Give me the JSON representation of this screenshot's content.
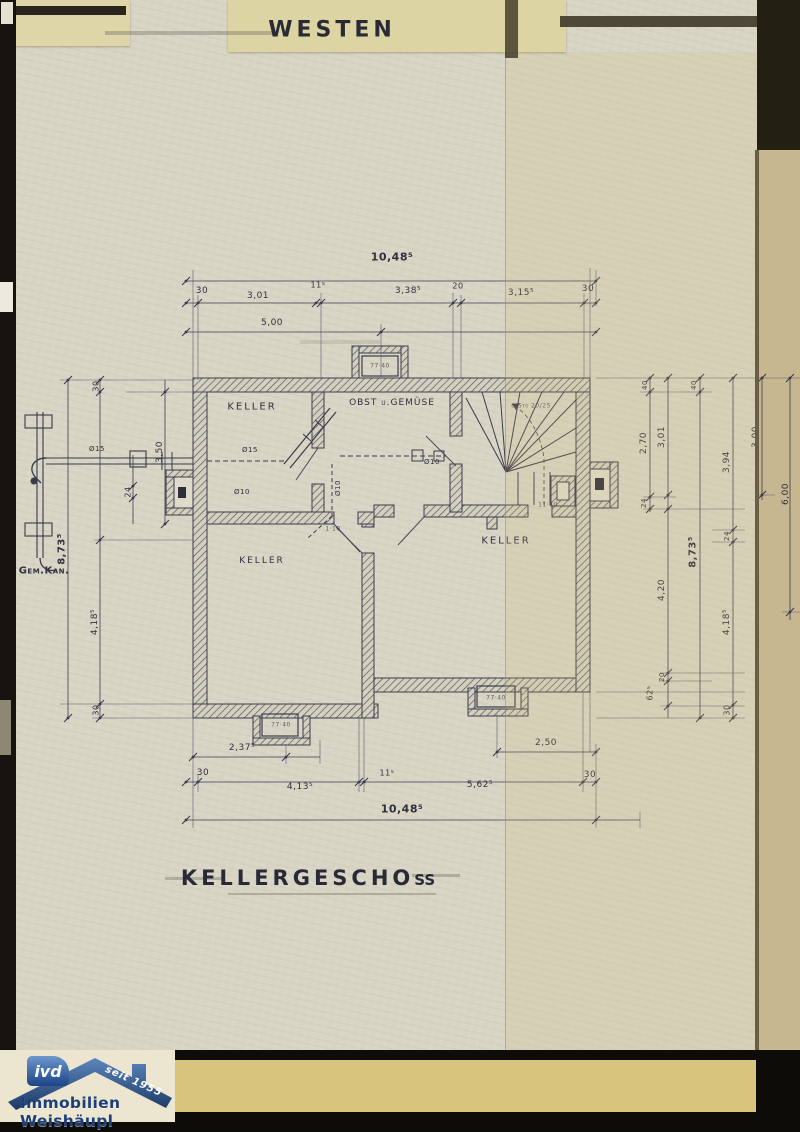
{
  "titles": {
    "west": "WESTEN",
    "floor": "KELLERGESCHOß"
  },
  "rooms": {
    "keller_upper_left": "KELLER",
    "obst": "OBST u.GEMÜSE",
    "keller_lower_left": "KELLER",
    "keller_right": "KELLER"
  },
  "notes": {
    "sewer": "Gem.Kan.",
    "stair": "6 Stg 20/25",
    "d15a": "Ø15",
    "d15b": "Ø15",
    "d10a": "Ø10",
    "d10b": "Ø10",
    "d10c": "Ø10",
    "n1140": "11·40",
    "n110": "1·10",
    "lw_top": "77·40",
    "lw_bl": "77·40",
    "lw_br": "77·40"
  },
  "dim": {
    "top": {
      "overall": "10,48⁵",
      "s30l": "30",
      "s301": "3,01",
      "s115": "11⁵",
      "s3385": "3,38⁵",
      "s20": "20",
      "s3155": "3,15⁵",
      "s30r": "30",
      "s500": "5,00"
    },
    "bottom": {
      "overall": "10,48⁵",
      "s2375": "2,37⁵",
      "s250": "2,50",
      "s30l": "30",
      "s4135": "4,13⁵",
      "s115": "11⁵",
      "s5625": "5,62⁵",
      "s30r": "30"
    },
    "left": {
      "s30t": "30",
      "s350": "3,50",
      "s24": "24",
      "s8735": "8,73⁵",
      "s4185": "4,18⁵",
      "s30b": "30"
    },
    "right": {
      "s40a": "40",
      "s270": "2,70",
      "s301": "3,01",
      "s40b": "40",
      "s394": "3,94",
      "s300": "3,00",
      "s600": "6,00",
      "s24a": "24",
      "s8735": "8,73⁵",
      "s420": "4,20",
      "s20": "20",
      "s625": "62⁵",
      "s24b": "24",
      "s4185": "4,18⁵",
      "s30": "30"
    }
  },
  "logo": {
    "badge": "ivd",
    "since": "seit 1955",
    "company": "Immobilien Weishäupl"
  },
  "colors": {
    "ink": "#30303f",
    "paper": "#d8d5c5",
    "tape": "#ded5a8",
    "mustard": "#d9c47e",
    "logo_blue": "#1d3f77"
  }
}
